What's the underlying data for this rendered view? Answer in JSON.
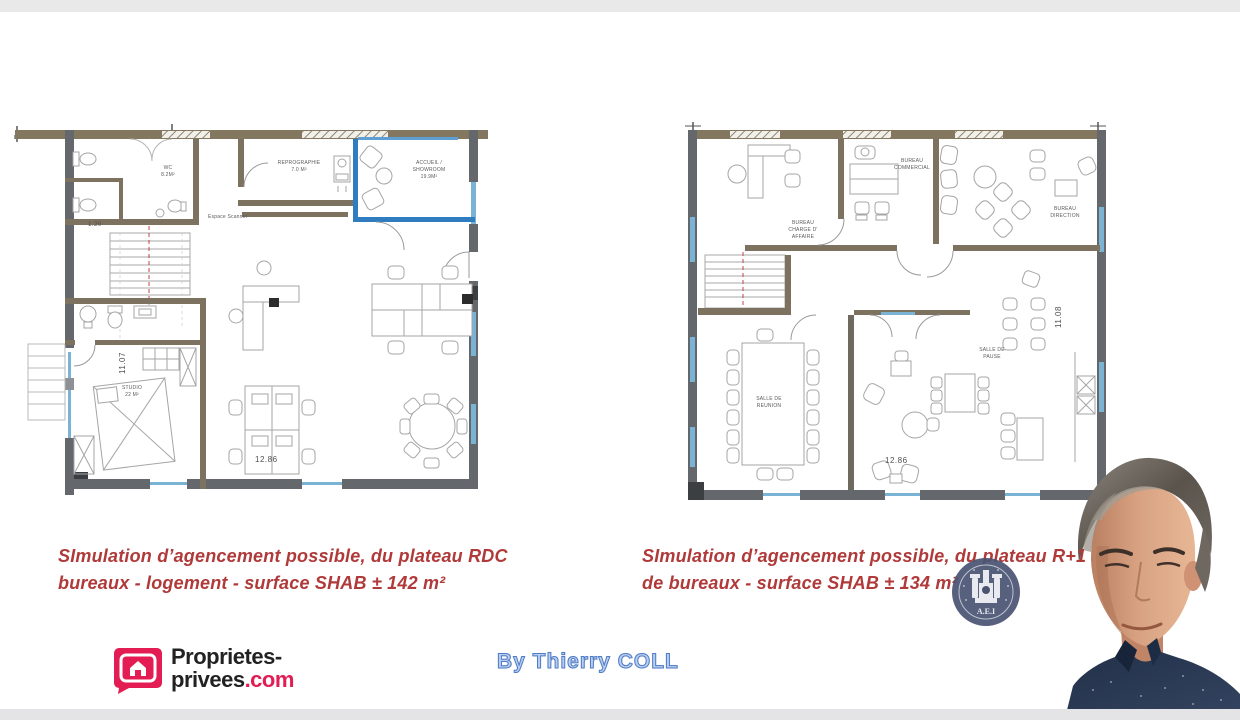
{
  "page": {
    "background": "#ffffff",
    "strip_color": "#e9e9ea"
  },
  "captions": {
    "color": "#b03a3a",
    "left_line1": "SImulation d’agencement possible, du plateau RDC",
    "left_line2": "bureaux - logement  - surface SHAB ± 142 m²",
    "right_line1": "SImulation d’agencement possible, du plateau R+1",
    "right_line2": "de bureaux  - surface SHAB ± 134 m²"
  },
  "branding": {
    "logo_line1": "Proprietes-",
    "logo_line2_black": "privees",
    "logo_line2_pink": ".com",
    "logo_pink": "#e31d53",
    "byline": "By Thierry COLL",
    "byline_color": "#4f7cc6"
  },
  "stamp": {
    "text": "A.E.I",
    "color": "#4a5472"
  },
  "plan_left": {
    "name": "Plateau RDC - bureaux / logement",
    "wall_brown": "#847760",
    "wall_gray": "#64676b",
    "accent_blue": "#2f7cc0",
    "labels": {
      "wc_line1": "WC",
      "wc_line2": "8.2M²",
      "repro_line1": "REPROGRAPHIE",
      "repro_line2": "7.0 M²",
      "accueil_line1": "ACCUEIL /",
      "accueil_line2": "SHOWROOM",
      "accueil_line3": "19.9M²",
      "scanner": "Espace Scanner",
      "studio_line1": "STUDIO",
      "studio_line2": "22 M²",
      "dim_stair": "1.20",
      "dim_vertical": "11.07",
      "dim_horizontal": "12.86"
    }
  },
  "plan_right": {
    "name": "Plateau R+1 - bureaux",
    "labels": {
      "charge_line1": "BUREAU",
      "charge_line2": "CHARGE D'",
      "charge_line3": "AFFAIRE",
      "commercial_line1": "BUREAU",
      "commercial_line2": "COMMERCIAL",
      "direction_line1": "BUREAU",
      "direction_line2": "DIRECTION",
      "reunion_line1": "SALLE DE",
      "reunion_line2": "REUNION",
      "pause_line1": "SALLE DE",
      "pause_line2": "PAUSE",
      "dim_vertical": "11.08",
      "dim_horizontal": "12.86"
    }
  }
}
